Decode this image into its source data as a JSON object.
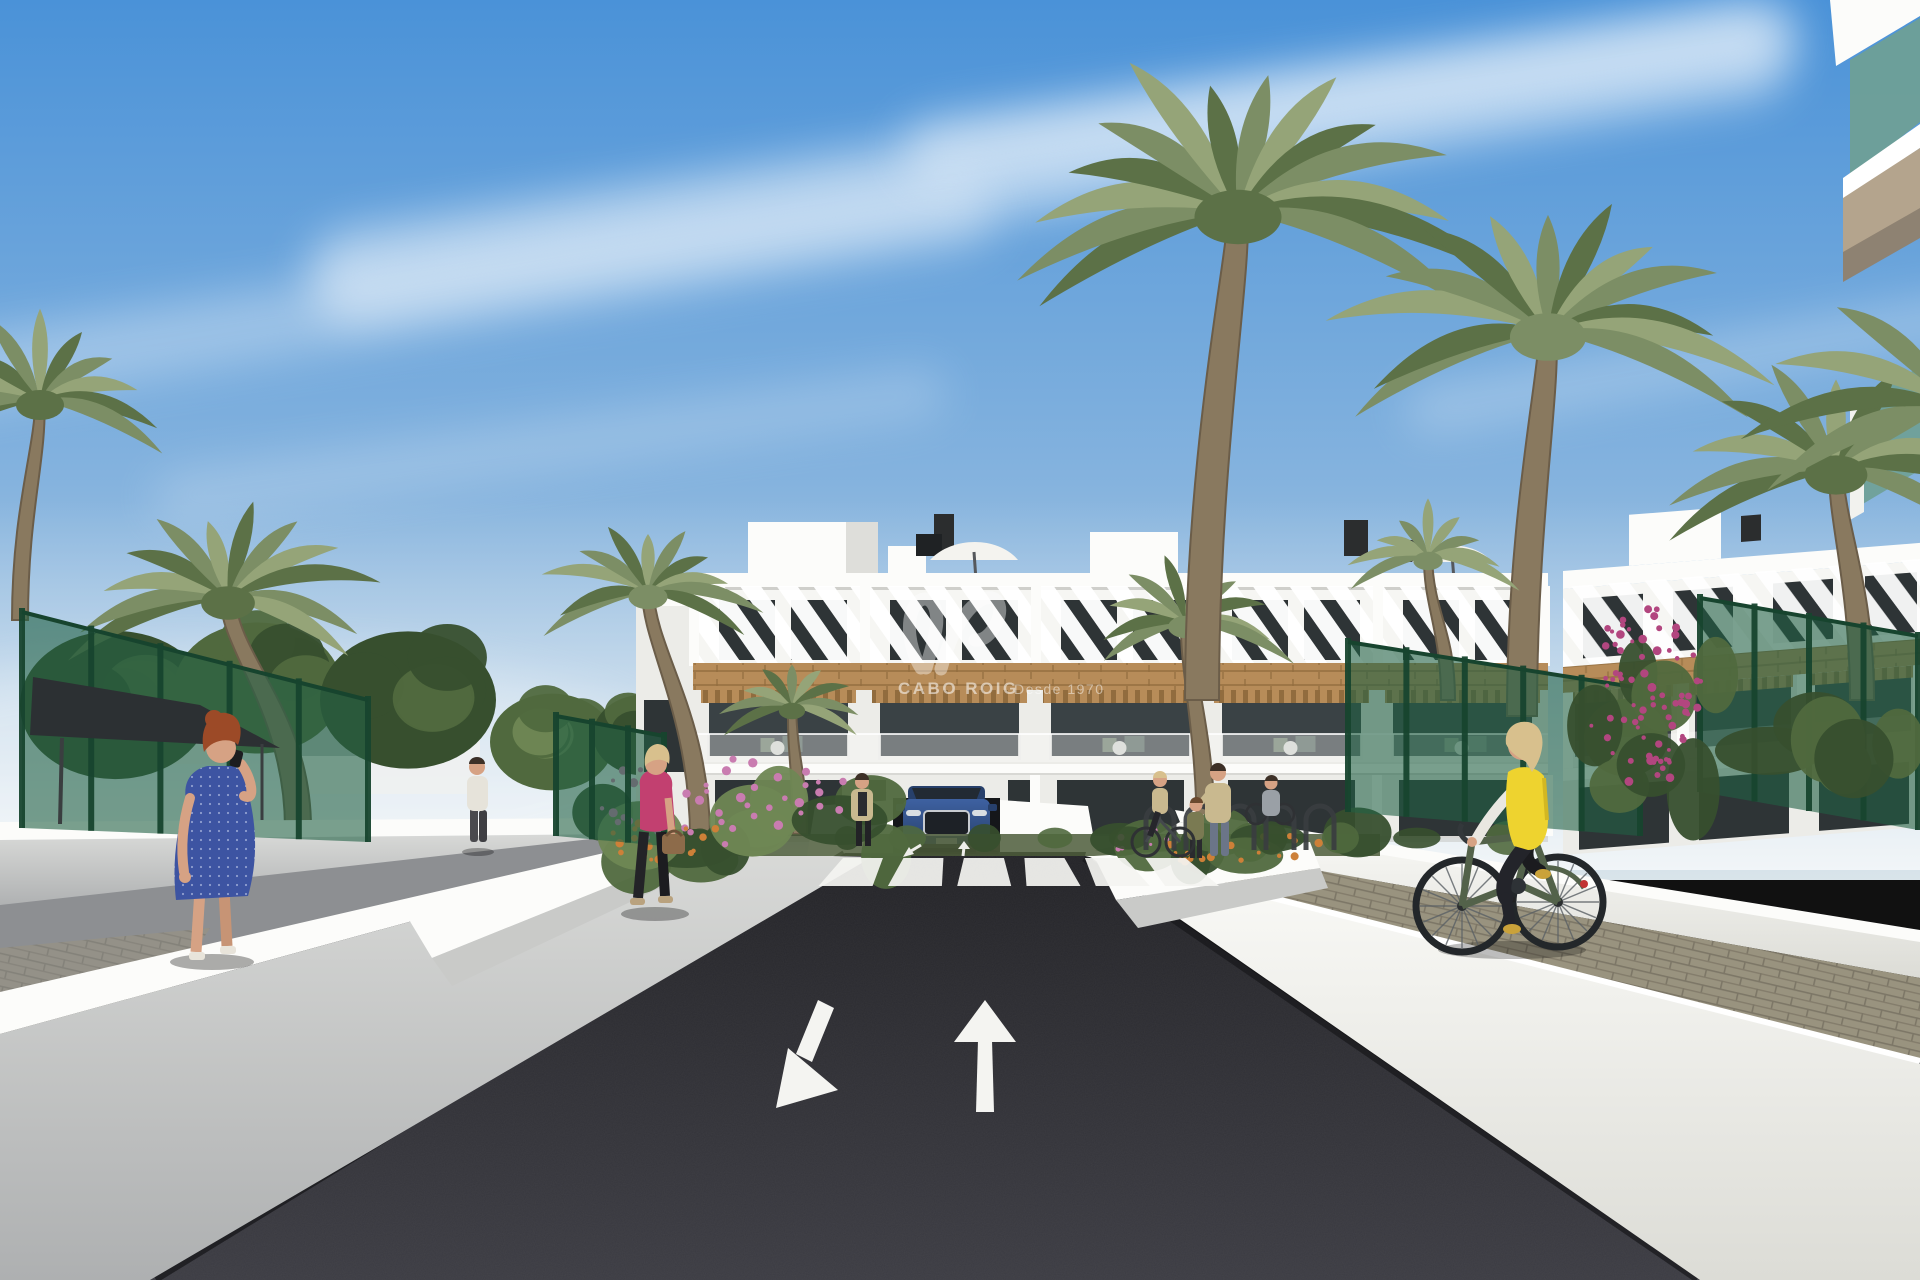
{
  "meta": {
    "description": "3D architectural rendering of a new-build Mediterranean apartment complex street scene with palm trees, two-way access road, crosswalk, pedestrians and a cyclist"
  },
  "watermark": {
    "brand": "CABO ROIG",
    "tagline": "Desde 1970",
    "logo_icon": "script-monogram-icon"
  },
  "road_markings": {
    "left_lane_arrow_icon": "arrow-down-left",
    "right_lane_arrow_icon": "arrow-up",
    "crosswalk_stripes": 6
  },
  "palette": {
    "sky_top": "#4a92d8",
    "sky_mid": "#85b3de",
    "sky_low": "#d9e4ea",
    "cloud": "#ffffff",
    "haze": "#eef2f4",
    "asphalt_hi": "#232327",
    "asphalt_lo": "#3c3c43",
    "road_white": "#f4f4f1",
    "wall_bright": "#fcfcfa",
    "wall_light": "#ecece8",
    "wall_mid": "#c9cac8",
    "wall_gray": "#9fa1a4",
    "wall_dark": "#6f7174",
    "path_gray": "#8d8f92",
    "paver": "#99937f",
    "paver_line": "#7d7767",
    "wood": "#b78c59",
    "wood_dark": "#916c3e",
    "window_dark": "#2e3436",
    "interior_dark": "#3a4245",
    "glass_teal": "#6fa095",
    "soffit_tan": "#b4a48d",
    "fence_green": "#226044",
    "fence_post": "#17442e",
    "leaf_dark": "#374f2e",
    "leaf_mid": "#50693e",
    "leaf_light": "#6f8754",
    "palm_g": "#7c8e65",
    "palm_dark": "#5c7147",
    "palm_light": "#95a478",
    "trunk": "#89795f",
    "trunk_dark": "#6b5d49",
    "grass": "#4c5c3a",
    "flower_pink": "#c97cb0",
    "flower_magenta": "#b2467f",
    "flower_orange": "#cd8038",
    "car_blue": "#3e61a1",
    "car_blue_dark": "#27406b",
    "chrome": "#c7cbd0",
    "skin": "#d6a284",
    "hair_red": "#9c4a27",
    "hair_blonde": "#d8c08d",
    "hair_dark": "#3d3027",
    "dress_blue": "#3d54a2",
    "jacket_pink": "#c24070",
    "vest_yellow": "#eed32f",
    "cloth_dark": "#26262b",
    "shirt_light": "#e6e3da",
    "denim": "#6b7588",
    "bag_brown": "#8d6b4a",
    "jacket_tan": "#c9b98f",
    "top_olive": "#7a7a52",
    "bike_green": "#53624a",
    "bike_dark": "#33383b",
    "canopy": "#2c3033",
    "shadow": "#141417"
  }
}
